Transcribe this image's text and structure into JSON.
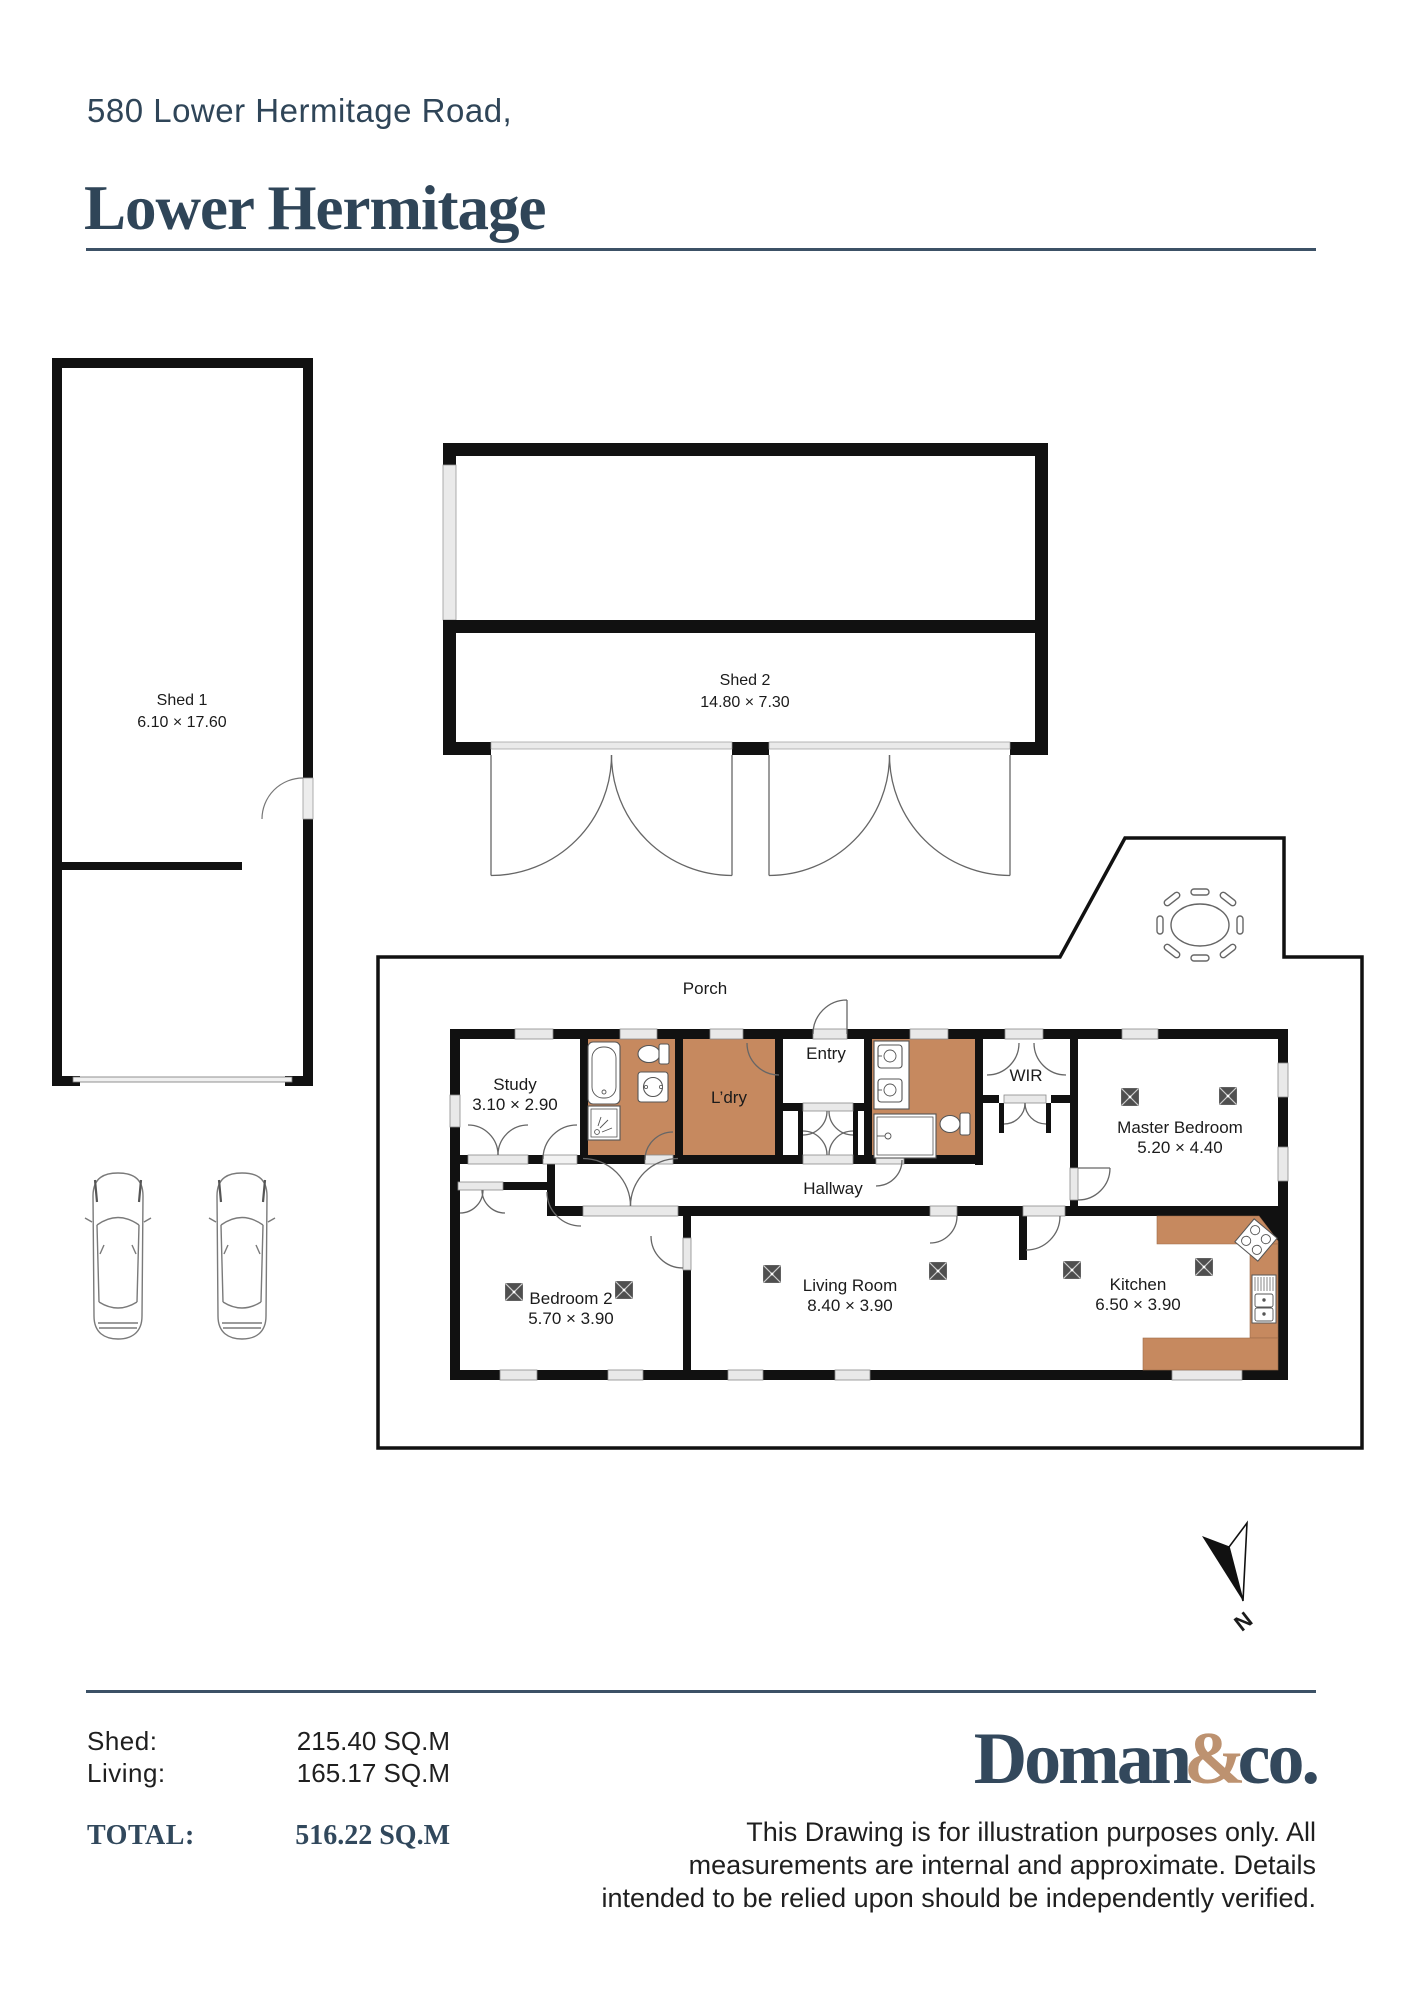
{
  "header": {
    "address_line": "580 Lower Hermitage Road,",
    "suburb": "Lower Hermitage"
  },
  "plan": {
    "sheds": {
      "shed1": {
        "name": "Shed 1",
        "dims": "6.10 × 17.60"
      },
      "shed2": {
        "name": "Shed 2",
        "dims": "14.80 × 7.30"
      }
    },
    "rooms": {
      "porch": {
        "name": "Porch"
      },
      "study": {
        "name": "Study",
        "dims": "3.10 × 2.90"
      },
      "ldry": {
        "name": "L’dry"
      },
      "entry": {
        "name": "Entry"
      },
      "wir": {
        "name": "WIR"
      },
      "master": {
        "name": "Master Bedroom",
        "dims": "5.20 × 4.40"
      },
      "hallway": {
        "name": "Hallway"
      },
      "bedroom2": {
        "name": "Bedroom 2",
        "dims": "5.70 × 3.90"
      },
      "living": {
        "name": "Living Room",
        "dims": "8.40 × 3.90"
      },
      "kitchen": {
        "name": "Kitchen",
        "dims": "6.50 × 3.90"
      }
    },
    "compass": {
      "label": "N"
    }
  },
  "footer": {
    "areas": [
      {
        "label": "Shed:",
        "value": "215.40 SQ.M"
      },
      {
        "label": "Living:",
        "value": "165.17 SQ.M"
      }
    ],
    "total_label": "TOTAL:",
    "total_value": "516.22 SQ.M",
    "logo": {
      "part1": "Doman",
      "amp": "&",
      "part2": "co."
    },
    "disclaimer_lines": [
      "This Drawing is for illustration purposes only. All",
      "measurements are internal and approximate. Details",
      "intended to be relied upon should be independently verified."
    ]
  },
  "colors": {
    "navy": "#2f4558",
    "wall_black": "#111111",
    "floor_orange": "#c6895f",
    "logo_tan": "#bd9270"
  }
}
